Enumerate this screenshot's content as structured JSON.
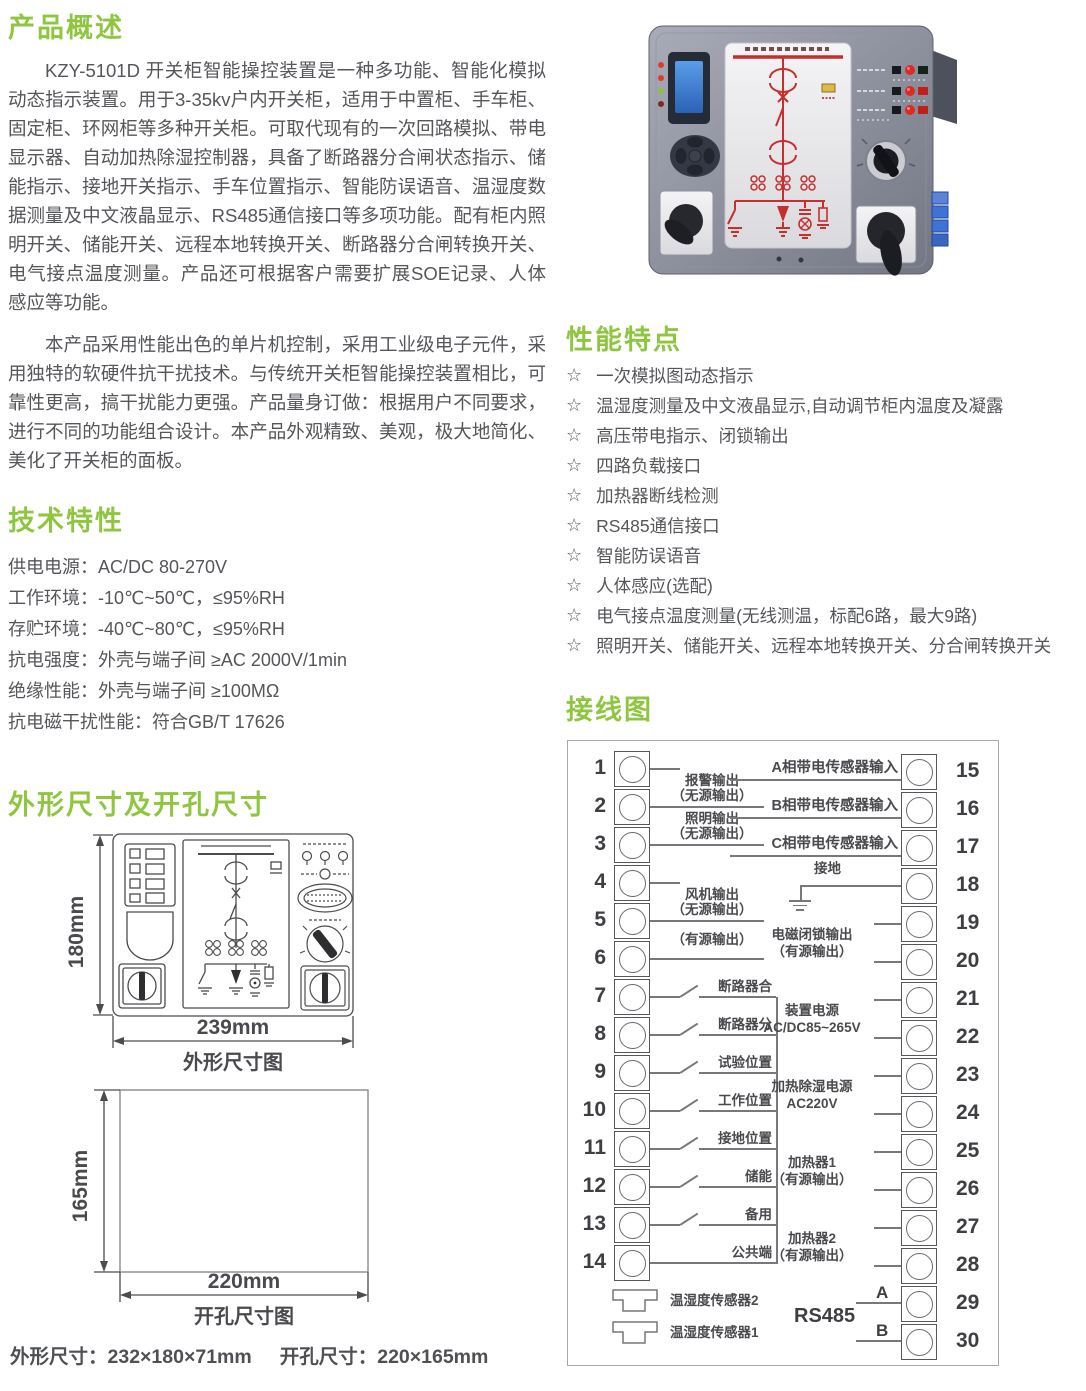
{
  "colors": {
    "accent": "#8fc63f",
    "text": "#55565a",
    "diagram_line": "#4c4c4f",
    "mimic_red": "#c5302f"
  },
  "overview": {
    "heading": "产品概述",
    "para1": "KZY-5101D 开关柜智能操控装置是一种多功能、智能化模拟动态指示装置。用于3-35kv户内开关柜，适用于中置柜、手车柜、固定柜、环网柜等多种开关柜。可取代现有的一次回路模拟、带电显示器、自动加热除湿控制器，具备了断路器分合闸状态指示、储能指示、接地开关指示、手车位置指示、智能防误语音、温湿度数据测量及中文液晶显示、RS485通信接口等多项功能。配有柜内照明开关、储能开关、远程本地转换开关、断路器分合闸转换开关、电气接点温度测量。产品还可根据客户需要扩展SOE记录、人体感应等功能。",
    "para2": "本产品采用性能出色的单片机控制，采用工业级电子元件，采用独特的软硬件抗干扰技术。与传统开关柜智能操控装置相比，可靠性更高，搞干扰能力更强。产品量身订做：根据用户不同要求，进行不同的功能组合设计。本产品外观精致、美观，极大地简化、美化了开关柜的面板。"
  },
  "tech": {
    "heading": "技术特性",
    "items": [
      "供电电源：AC/DC 80-270V",
      "工作环境：-10℃~50℃，≤95%RH",
      "存贮环境：-40℃~80℃，≤95%RH",
      "抗电强度：外壳与端子间 ≥AC 2000V/1min",
      "绝缘性能：外壳与端子间 ≥100MΩ",
      "抗电磁干扰性能：符合GB/T 17626"
    ]
  },
  "dims": {
    "heading": "外形尺寸及开孔尺寸",
    "outline_h": "180mm",
    "outline_w": "239mm",
    "outline_caption": "外形尺寸图",
    "cutout_h": "165mm",
    "cutout_w": "220mm",
    "cutout_caption": "开孔尺寸图",
    "summary_outline": "外形尺寸：232×180×71mm",
    "summary_cutout": "开孔尺寸：220×165mm"
  },
  "features": {
    "heading": "性能特点",
    "bullet": "☆",
    "items": [
      "一次模拟图动态指示",
      "温湿度测量及中文液晶显示,自动调节柜内温度及凝露",
      "高压带电指示、闭锁输出",
      "四路负载接口",
      "加热器断线检测",
      "RS485通信接口",
      "智能防误语音",
      "人体感应(选配)",
      "电气接点温度测量(无线测温，标配6路，最大9路)",
      "照明开关、储能开关、远程本地转换开关、分合闸转换开关"
    ]
  },
  "wiring": {
    "heading": "接线图",
    "left_terminals": [
      "1",
      "2",
      "3",
      "4",
      "5",
      "6",
      "7",
      "8",
      "9",
      "10",
      "11",
      "12",
      "13",
      "14"
    ],
    "right_terminals": [
      "15",
      "16",
      "17",
      "18",
      "19",
      "20",
      "21",
      "22",
      "23",
      "24",
      "25",
      "26",
      "27",
      "28",
      "29",
      "30"
    ],
    "left_groups": [
      {
        "rows": [
          1,
          2
        ],
        "lines": [
          "报警输出",
          "（无源输出）"
        ]
      },
      {
        "rows": [
          2,
          3
        ],
        "lines": [
          "照明输出",
          "（无源输出）"
        ]
      },
      {
        "rows": [
          4,
          5
        ],
        "lines": [
          "风机输出",
          "（无源输出）"
        ]
      },
      {
        "rows": [
          5,
          6
        ],
        "lines": [
          "（有源输出）"
        ]
      }
    ],
    "switch_rows": [
      {
        "row": 7,
        "label": "断路器合"
      },
      {
        "row": 8,
        "label": "断路器分"
      },
      {
        "row": 9,
        "label": "试验位置"
      },
      {
        "row": 10,
        "label": "工作位置"
      },
      {
        "row": 11,
        "label": "接地位置"
      },
      {
        "row": 12,
        "label": "储能"
      },
      {
        "row": 13,
        "label": "备用"
      }
    ],
    "common": {
      "row": 14,
      "label": "公共端"
    },
    "right_singles": [
      {
        "row": 15,
        "label": "A相带电传感器输入"
      },
      {
        "row": 16,
        "label": "B相带电传感器输入"
      },
      {
        "row": 17,
        "label": "C相带电传感器输入"
      }
    ],
    "ground": {
      "row": 18,
      "label": "接地"
    },
    "right_groups": [
      {
        "rows": [
          19,
          20
        ],
        "lines": [
          "电磁闭锁输出",
          "（有源输出）"
        ]
      },
      {
        "rows": [
          21,
          22
        ],
        "lines": [
          "装置电源",
          "AC/DC85~265V"
        ]
      },
      {
        "rows": [
          23,
          24
        ],
        "lines": [
          "加热除湿电源",
          "AC220V"
        ]
      },
      {
        "rows": [
          25,
          26
        ],
        "lines": [
          "加热器1",
          "（有源输出）"
        ]
      },
      {
        "rows": [
          27,
          28
        ],
        "lines": [
          "加热器2",
          "（有源输出）"
        ]
      }
    ],
    "rs485": {
      "label": "RS485",
      "a": {
        "row": 29,
        "label": "A"
      },
      "b": {
        "row": 30,
        "label": "B"
      }
    },
    "sensors": [
      {
        "label": "温湿度传感器2"
      },
      {
        "label": "温湿度传感器1"
      }
    ]
  }
}
